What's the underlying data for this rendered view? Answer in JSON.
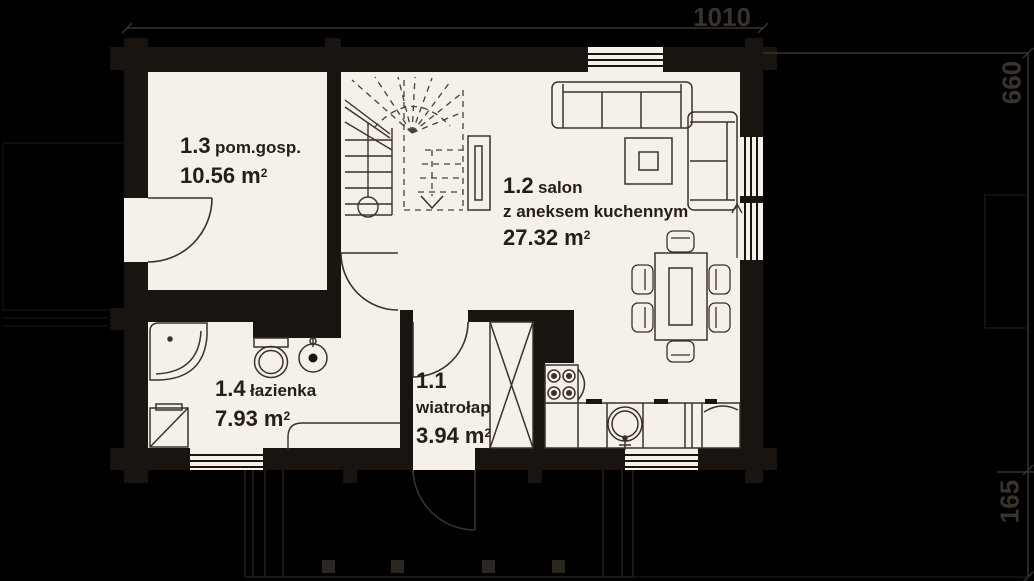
{
  "plan_title": "parter - rzut",
  "dimensions": {
    "width_cm": "1010",
    "height_cm": "660",
    "porch_depth_cm": "165"
  },
  "rooms": {
    "hall": {
      "number": "1.1",
      "name": "wiatrołap",
      "area": "3.94 m",
      "area_sup": "2"
    },
    "salon": {
      "number": "1.2",
      "name": "salon",
      "subtitle": "z aneksem kuchennym",
      "area": "27.32 m",
      "area_sup": "2"
    },
    "utility": {
      "number": "1.3",
      "name": "pom.gosp.",
      "area": "10.56 m",
      "area_sup": "2"
    },
    "bathroom": {
      "number": "1.4",
      "name": "łazienka",
      "area": "7.93 m",
      "area_sup": "2"
    }
  },
  "colors": {
    "background": "#000000",
    "floor": "#f5f0e9",
    "wall": "#191410",
    "furniture_line": "#39322a",
    "label_text": "#241e17",
    "dimension_text": "#3a332c",
    "porch_line": "#262119"
  }
}
